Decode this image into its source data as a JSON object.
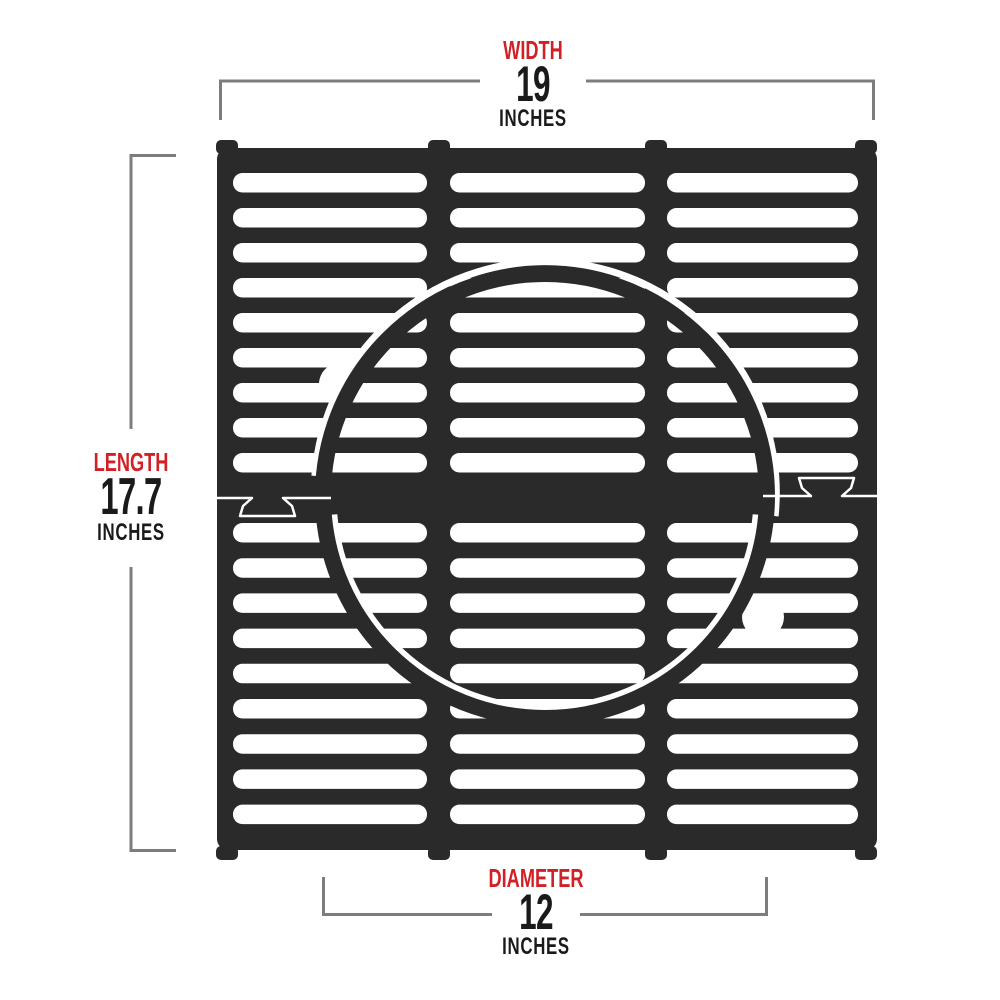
{
  "colors": {
    "accent_red": "#d22027",
    "text_black": "#1a1a1a",
    "dimension_line_gray": "#7d7d7d",
    "grate_dark": "#2a2a2a",
    "slot_white": "#ffffff"
  },
  "dimensions": {
    "width": {
      "label": "WIDTH",
      "value": "19",
      "unit": "INCHES"
    },
    "length": {
      "label": "LENGTH",
      "value": "17.7",
      "unit": "INCHES"
    },
    "diameter": {
      "label": "DIAMETER",
      "value": "12",
      "unit": "INCHES"
    }
  }
}
